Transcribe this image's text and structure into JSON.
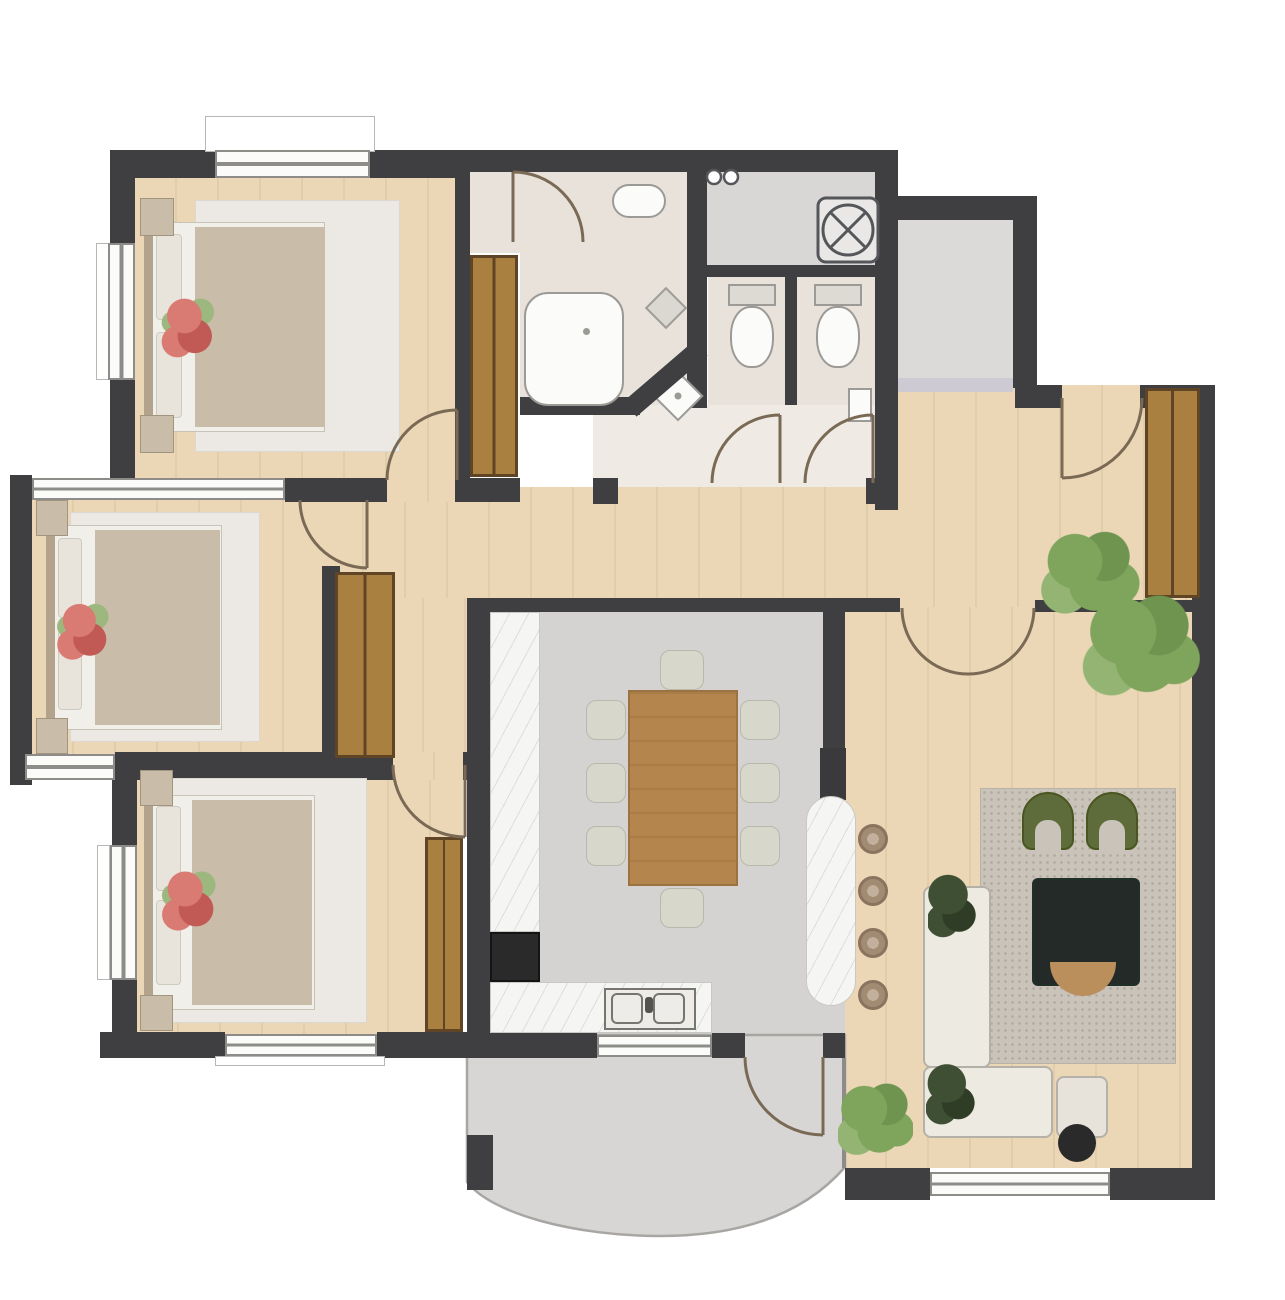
{
  "meta": {
    "kind": "apartment-floor-plan",
    "canvas_width_px": 1285,
    "canvas_height_px": 1300,
    "visible_text": "none"
  },
  "colors": {
    "wall": "#3F3F41",
    "wood": "#EBD7B6",
    "bath": "#E8E2DB",
    "bathlight": "#EFEBE4",
    "grayfloor": "#D4D3D1",
    "laundry": "#D8D7D5",
    "landing": "#DBDAD8",
    "balcony": "#D7D6D4",
    "marble": "#F5F5F3",
    "closet": "#A9803F",
    "closetedge": "#5F4426",
    "rugbed": "#ECE9E4",
    "bedsheet": "#F1EFEA",
    "duvet": "#C9BCA8",
    "pillow": "#E8E4DC",
    "headboard": "#B3A28C",
    "nightstand": "#C9BCA9",
    "flowerred": "#D97B72",
    "flowerdeep": "#C15A55",
    "leaf": "#7FA45C",
    "leafdark": "#3E4F33",
    "tablewood": "#B5854E",
    "chair": "#D8D7CB",
    "ruglive": "#C9C3BA",
    "olive": "#5E6C3C",
    "coffee": "#232A28",
    "sofa": "#EDEAE2",
    "sofaline": "#B5B1A8",
    "ottoman": "#E7E3DA",
    "stool": "#A28B73",
    "black": "#2A2A2A",
    "fixture": "#FBFBF9",
    "fixline": "#9C9A96",
    "doorarc": "#7A6A55",
    "threshold": "#CDCAD4",
    "winframe": "#8E8C88",
    "tan": "#BA8F5C"
  },
  "rooms": {
    "bedroom_top_left": {
      "floor": "wood",
      "items": [
        "double-bed",
        "rug",
        "nightstand-x2",
        "red-flowers",
        "window-top",
        "window-left",
        "door"
      ]
    },
    "bedroom_middle_left": {
      "floor": "wood",
      "items": [
        "double-bed",
        "rug",
        "nightstand-x2",
        "red-flowers",
        "bay-window",
        "door",
        "wardrobe"
      ]
    },
    "bedroom_bottom_left": {
      "floor": "wood",
      "items": [
        "double-bed",
        "rug",
        "nightstand-x2",
        "red-flowers",
        "window-left",
        "window-bottom",
        "door",
        "wardrobe"
      ]
    },
    "shower_room": {
      "floor": "bath",
      "items": [
        "shower-tray",
        "wall-basin",
        "corner-basin",
        "shelf",
        "door",
        "diagonal-wall"
      ]
    },
    "laundry_nook": {
      "floor": "gray",
      "items": [
        "washing-machine",
        "pivot-door"
      ]
    },
    "wc_1": {
      "floor": "bath",
      "items": [
        "toilet",
        "door"
      ]
    },
    "wc_2": {
      "floor": "bath",
      "items": [
        "toilet",
        "corner-sink",
        "door"
      ]
    },
    "entry_landing": {
      "floor": "gray",
      "items": [
        "threshold-mat"
      ]
    },
    "entry_hall": {
      "floor": "wood",
      "items": [
        "entry-door",
        "wardrobe",
        "plant",
        "french-doors"
      ]
    },
    "corridor": {
      "floor": "wood",
      "items": [
        "wardrobe"
      ]
    },
    "kitchen_dining": {
      "floor": "gray",
      "items": [
        "counter-left",
        "oven",
        "counter-bottom",
        "double-sink",
        "island",
        "tall-cabinet",
        "dining-table",
        "chairs-x8",
        "window-to-balcony"
      ]
    },
    "living_room": {
      "floor": "wood",
      "items": [
        "area-rug",
        "armchair-x2",
        "coffee-table",
        "corner-sofa",
        "ottoman",
        "round-side-table",
        "bar-stools-x4",
        "plants-x4",
        "window-bottom",
        "french-doors"
      ]
    },
    "balcony": {
      "floor": "gray",
      "items": [
        "curved-parapet",
        "door-from-living"
      ]
    }
  }
}
